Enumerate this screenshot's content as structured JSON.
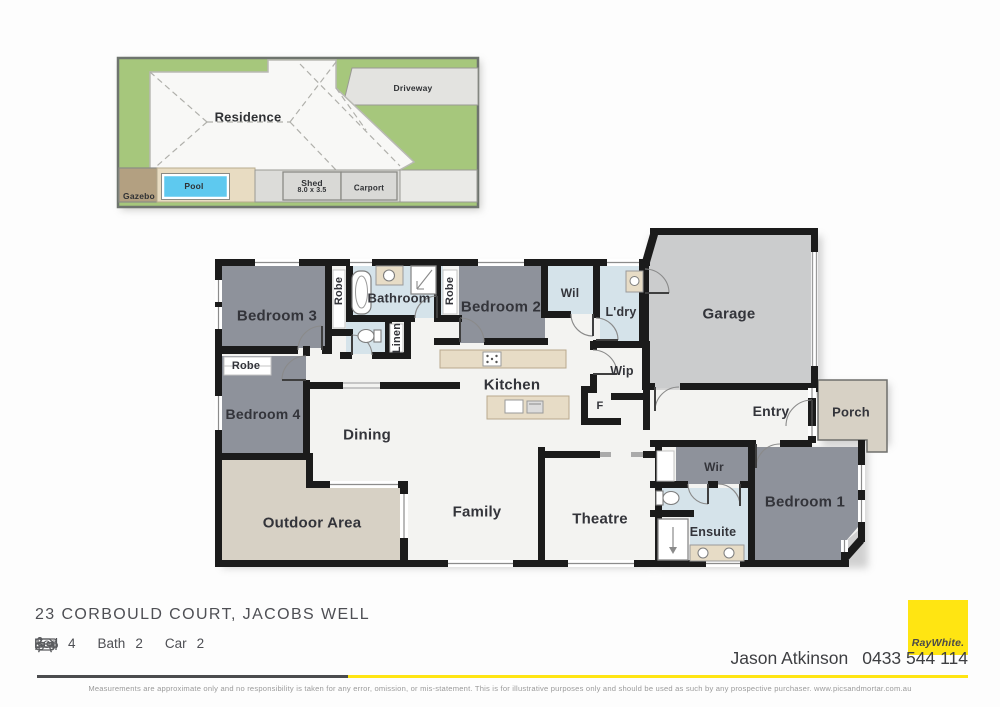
{
  "site_plan": {
    "residence": "Residence",
    "driveway": "Driveway",
    "gazebo": "Gazebo",
    "pool": "Pool",
    "shed": "Shed",
    "shed_size": "8.0 x 3.5",
    "carport": "Carport"
  },
  "floor_plan": {
    "bedroom3": "Bedroom 3",
    "robe_bed3": "Robe",
    "bathroom": "Bathroom",
    "robe_bed2": "Robe",
    "bedroom2": "Bedroom 2",
    "wil": "Wil",
    "ldry": "L'dry",
    "garage": "Garage",
    "linen": "Linen",
    "robe_bed4": "Robe",
    "bedroom4": "Bedroom 4",
    "kitchen": "Kitchen",
    "wip": "Wip",
    "fridge": "F",
    "entry": "Entry",
    "porch": "Porch",
    "dining": "Dining",
    "outdoor": "Outdoor Area",
    "family": "Family",
    "theatre": "Theatre",
    "wir": "Wir",
    "ensuite": "Ensuite",
    "bedroom1": "Bedroom 1"
  },
  "footer": {
    "address": "23 CORBOULD COURT, JACOBS WELL",
    "bed_label": "Bed",
    "bed_value": "4",
    "bath_label": "Bath",
    "bath_value": "2",
    "car_label": "Car",
    "car_value": "2",
    "agent": "Jason Atkinson",
    "phone": "0433 544 114",
    "brand": "RayWhite.",
    "disclaimer": "Measurements are approximate only and no responsibility is taken for any error, omission, or mis-statement. This is for illustrative purposes only and should be used as such by any prospective purchaser. www.picsandmortar.com.au"
  },
  "colors": {
    "brand_yellow": "#ffe512",
    "carpet": "#8e929b",
    "garage_floor": "#cbcccd",
    "wet_area": "#d5e3ea",
    "bench_timber": "#e7dcc6",
    "outdoor_paving": "#d7d1c5",
    "grass": "#a6c77c",
    "pool_water": "#5ec9ef",
    "wall": "#1b1b1b"
  }
}
